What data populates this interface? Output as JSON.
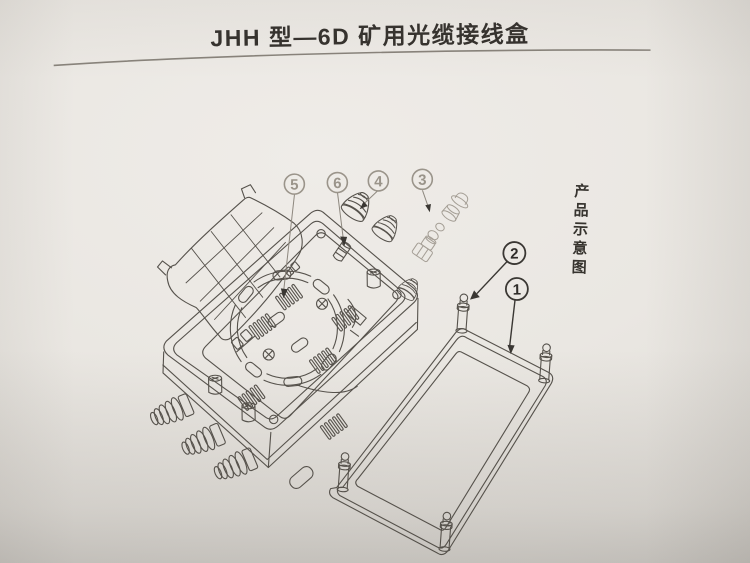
{
  "page": {
    "title": "JHH 型—6D 矿用光缆接线盒",
    "side_label": "产品示意图"
  },
  "figure": {
    "type": "exploded-assembly-line-drawing",
    "callouts": [
      {
        "label": "5",
        "style": "faint"
      },
      {
        "label": "6",
        "style": "faint"
      },
      {
        "label": "4",
        "style": "faint"
      },
      {
        "label": "3",
        "style": "faint"
      },
      {
        "label": "2",
        "style": "dark"
      },
      {
        "label": "1",
        "style": "dark"
      }
    ]
  },
  "colors": {
    "paper": "#eae7e2",
    "line_dark": "#56524c",
    "line_faint": "#a49e95",
    "text": "#34312d"
  }
}
